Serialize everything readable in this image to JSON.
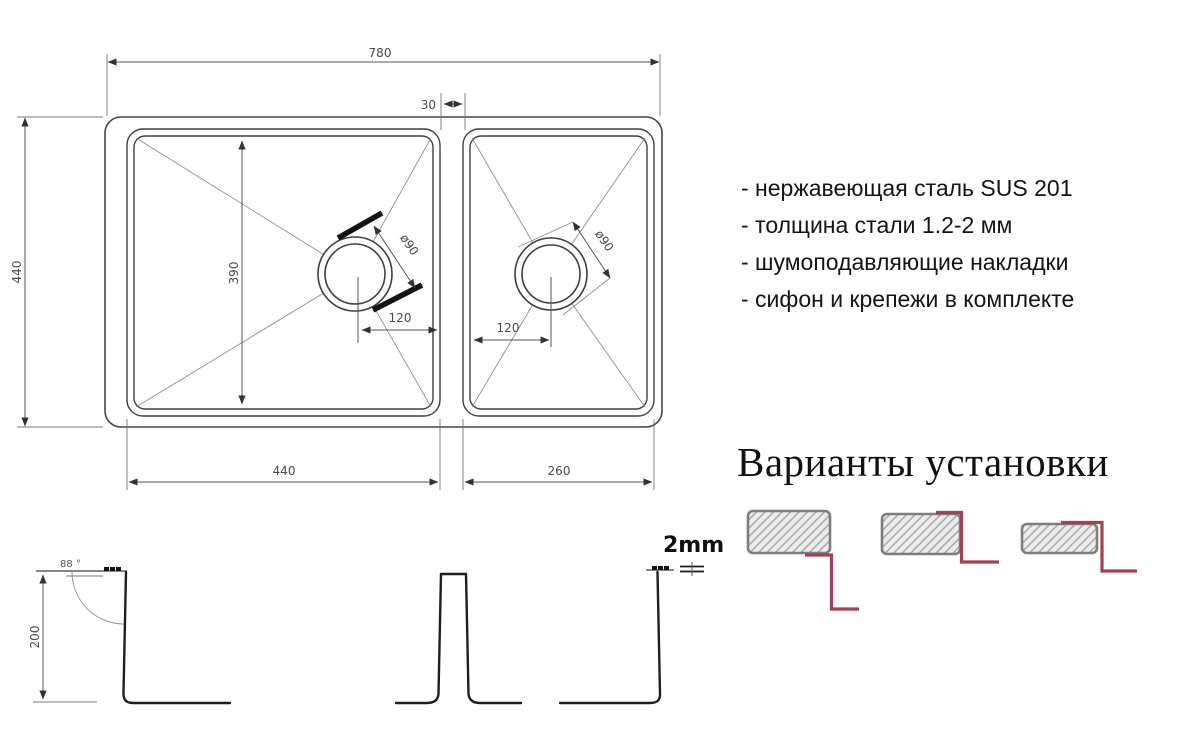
{
  "drawing": {
    "top_view": {
      "width_total": "780",
      "height_total": "440",
      "divider_gap": "30",
      "bowl_left_inner_depth": "390",
      "bowl_left_width": "440",
      "bowl_right_width": "260",
      "drain_left_diameter": "ø90",
      "drain_right_diameter": "ø90",
      "drain_left_offset": "120",
      "drain_right_offset": "120"
    },
    "side_view": {
      "bowl_depth": "200",
      "wall_angle": "88 °",
      "steel_thickness": "2mm"
    }
  },
  "specs": {
    "items": [
      "- нержавеющая сталь SUS 201",
      "- толщина стали 1.2-2 мм",
      "- шумоподавляющие накладки",
      "- сифон и крепежи в комплекте"
    ]
  },
  "installation": {
    "heading": "Варианты установки"
  },
  "colors": {
    "accent_red": "#a04156",
    "drawing_line": "#3f3f3f",
    "counter_border": "#7e7e7e"
  }
}
